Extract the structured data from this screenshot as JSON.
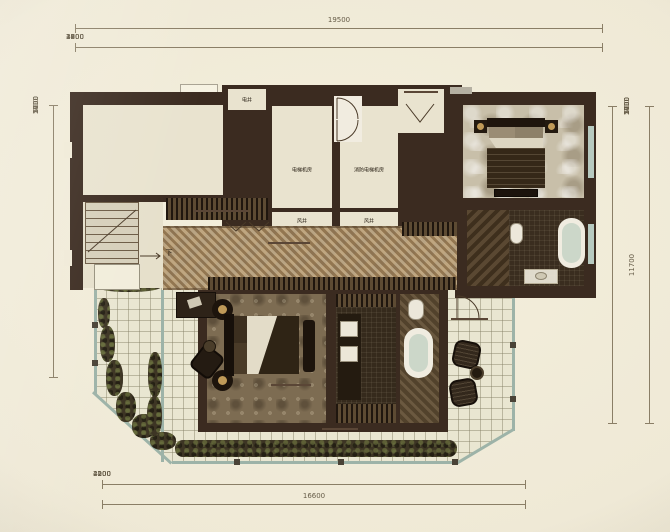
{
  "dimensions": {
    "top": {
      "total": "19500",
      "segments": [
        "1000",
        "2600",
        "1200",
        "2400",
        "4800",
        "3800",
        "3700"
      ]
    },
    "left": {
      "segments": [
        "1700",
        "1400",
        "700",
        "2900",
        "5000"
      ]
    },
    "right": {
      "total": "11700",
      "segments": [
        "1700",
        "1400",
        "700",
        "2900",
        "5000"
      ]
    },
    "bottom": {
      "total": "16600",
      "segments": [
        "2100",
        "2000",
        "4200",
        "4200",
        "4100"
      ]
    }
  },
  "labels": {
    "electric_shaft": "电井",
    "elevator_machine_room": "电梯机房",
    "fire_elevator_machine_room": "消防电梯机房",
    "air_shaft_a": "风井",
    "air_shaft_b": "风井",
    "water_pipe_shaft": "水管井",
    "cloakroom_zh": "衣帽间",
    "cloakroom_en": "CLOAKROOM",
    "corridor_zh": "过道",
    "corridor_en": "CORRIDOR",
    "master_bedroom_zh": "主卧",
    "master_bedroom_en": "M.BEDROOM",
    "balcony_right_zh": "阳台",
    "balcony_right_en": "BALCONY",
    "balcony_bottom_zh": "阳台",
    "balcony_bottom_en": "BALCONY",
    "stairs_down": "下"
  },
  "colors": {
    "paper": "#f0ead7",
    "wall": "#3b2b20",
    "floor": "#e9e3cf",
    "tile": "#e9e6d1",
    "tile_line": "rgba(130,125,98,0.45)",
    "glass": "#9db3a8",
    "dim": "#8a7e66",
    "dim_text": "#655b47",
    "gold": "#c09a58",
    "white_fix": "#f1ece0"
  }
}
